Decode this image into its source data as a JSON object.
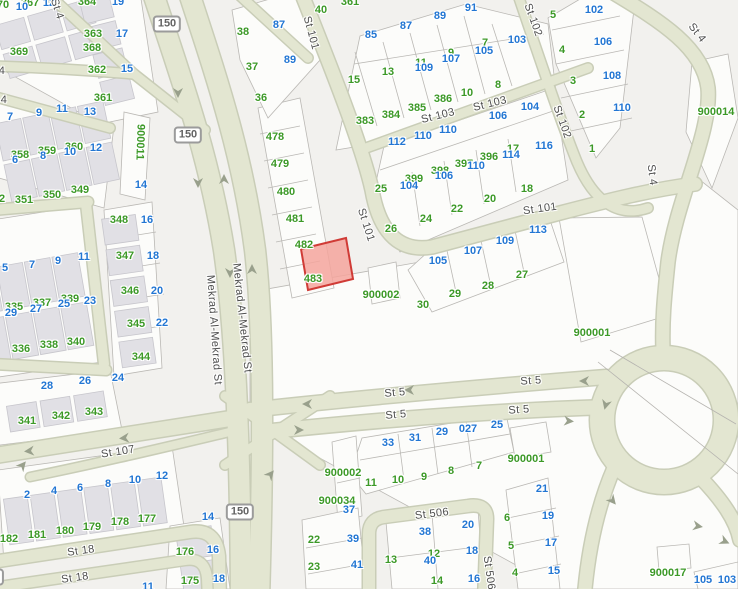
{
  "map": {
    "type": "cadastral-street-map",
    "colors": {
      "g": "#3c9927",
      "b": "#2276d3",
      "road_fill": "#e3e6d1",
      "road_casing": "#c9cdb7",
      "highlight_fill": "#f4a49c",
      "highlight_stroke": "#d03b36"
    },
    "highlighted_parcel": {
      "near_numbers": [
        "482",
        "483"
      ]
    },
    "number_labels": [
      {
        "t": "70",
        "x": 3,
        "y": 5,
        "c": "g"
      },
      {
        "t": "367",
        "x": 30,
        "y": 3,
        "c": "g"
      },
      {
        "t": "364",
        "x": 87,
        "y": 2,
        "c": "g"
      },
      {
        "t": "369",
        "x": 19,
        "y": 52,
        "c": "g"
      },
      {
        "t": "368",
        "x": 92,
        "y": 48,
        "c": "g"
      },
      {
        "t": "363",
        "x": 93,
        "y": 34,
        "c": "g"
      },
      {
        "t": "362",
        "x": 97,
        "y": 70,
        "c": "g"
      },
      {
        "t": "361",
        "x": 103,
        "y": 98,
        "c": "g"
      },
      {
        "t": "361",
        "x": 350,
        "y": 2,
        "c": "g"
      },
      {
        "t": "40",
        "x": 321,
        "y": 10,
        "c": "g"
      },
      {
        "t": "38",
        "x": 243,
        "y": 32,
        "c": "g"
      },
      {
        "t": "37",
        "x": 252,
        "y": 67,
        "c": "g"
      },
      {
        "t": "36",
        "x": 261,
        "y": 98,
        "c": "g"
      },
      {
        "t": "358",
        "x": 20,
        "y": 155,
        "c": "g"
      },
      {
        "t": "359",
        "x": 47,
        "y": 151,
        "c": "g"
      },
      {
        "t": "360",
        "x": 74,
        "y": 147,
        "c": "g"
      },
      {
        "t": "352",
        "x": -4,
        "y": 199,
        "c": "g"
      },
      {
        "t": "351",
        "x": 24,
        "y": 200,
        "c": "g"
      },
      {
        "t": "350",
        "x": 52,
        "y": 195,
        "c": "g"
      },
      {
        "t": "349",
        "x": 80,
        "y": 190,
        "c": "g"
      },
      {
        "t": "348",
        "x": 119,
        "y": 220,
        "c": "g"
      },
      {
        "t": "347",
        "x": 125,
        "y": 256,
        "c": "g"
      },
      {
        "t": "346",
        "x": 130,
        "y": 291,
        "c": "g"
      },
      {
        "t": "345",
        "x": 136,
        "y": 324,
        "c": "g"
      },
      {
        "t": "344",
        "x": 141,
        "y": 357,
        "c": "g"
      },
      {
        "t": "335",
        "x": 14,
        "y": 307,
        "c": "g"
      },
      {
        "t": "337",
        "x": 42,
        "y": 303,
        "c": "g"
      },
      {
        "t": "339",
        "x": 70,
        "y": 299,
        "c": "g"
      },
      {
        "t": "336",
        "x": 21,
        "y": 349,
        "c": "g"
      },
      {
        "t": "338",
        "x": 49,
        "y": 345,
        "c": "g"
      },
      {
        "t": "340",
        "x": 76,
        "y": 342,
        "c": "g"
      },
      {
        "t": "341",
        "x": 27,
        "y": 421,
        "c": "g"
      },
      {
        "t": "342",
        "x": 61,
        "y": 416,
        "c": "g"
      },
      {
        "t": "343",
        "x": 94,
        "y": 412,
        "c": "g"
      },
      {
        "t": "182",
        "x": 9,
        "y": 539,
        "c": "g"
      },
      {
        "t": "181",
        "x": 37,
        "y": 535,
        "c": "g"
      },
      {
        "t": "180",
        "x": 65,
        "y": 531,
        "c": "g"
      },
      {
        "t": "179",
        "x": 92,
        "y": 527,
        "c": "g"
      },
      {
        "t": "178",
        "x": 120,
        "y": 522,
        "c": "g"
      },
      {
        "t": "177",
        "x": 147,
        "y": 519,
        "c": "g"
      },
      {
        "t": "176",
        "x": 185,
        "y": 552,
        "c": "g"
      },
      {
        "t": "175",
        "x": 190,
        "y": 581,
        "c": "g"
      },
      {
        "t": "478",
        "x": 275,
        "y": 137,
        "c": "g"
      },
      {
        "t": "479",
        "x": 280,
        "y": 164,
        "c": "g"
      },
      {
        "t": "480",
        "x": 286,
        "y": 192,
        "c": "g"
      },
      {
        "t": "481",
        "x": 295,
        "y": 219,
        "c": "g"
      },
      {
        "t": "482",
        "x": 304,
        "y": 245,
        "c": "g"
      },
      {
        "t": "483",
        "x": 313,
        "y": 279,
        "c": "g"
      },
      {
        "t": "15",
        "x": 354,
        "y": 80,
        "c": "g"
      },
      {
        "t": "13",
        "x": 388,
        "y": 72,
        "c": "g"
      },
      {
        "t": "11",
        "x": 421,
        "y": 63,
        "c": "g"
      },
      {
        "t": "9",
        "x": 451,
        "y": 53,
        "c": "g"
      },
      {
        "t": "7",
        "x": 485,
        "y": 43,
        "c": "g"
      },
      {
        "t": "10",
        "x": 467,
        "y": 93,
        "c": "g"
      },
      {
        "t": "8",
        "x": 498,
        "y": 85,
        "c": "g"
      },
      {
        "t": "383",
        "x": 365,
        "y": 121,
        "c": "g"
      },
      {
        "t": "384",
        "x": 391,
        "y": 115,
        "c": "g"
      },
      {
        "t": "385",
        "x": 417,
        "y": 108,
        "c": "g"
      },
      {
        "t": "386",
        "x": 443,
        "y": 99,
        "c": "g"
      },
      {
        "t": "399",
        "x": 414,
        "y": 179,
        "c": "g"
      },
      {
        "t": "398",
        "x": 440,
        "y": 171,
        "c": "g"
      },
      {
        "t": "397",
        "x": 464,
        "y": 164,
        "c": "g"
      },
      {
        "t": "396",
        "x": 489,
        "y": 157,
        "c": "g"
      },
      {
        "t": "17",
        "x": 513,
        "y": 149,
        "c": "g"
      },
      {
        "t": "18",
        "x": 527,
        "y": 189,
        "c": "g"
      },
      {
        "t": "25",
        "x": 381,
        "y": 189,
        "c": "g"
      },
      {
        "t": "26",
        "x": 391,
        "y": 229,
        "c": "g"
      },
      {
        "t": "24",
        "x": 426,
        "y": 219,
        "c": "g"
      },
      {
        "t": "22",
        "x": 457,
        "y": 209,
        "c": "g"
      },
      {
        "t": "20",
        "x": 490,
        "y": 199,
        "c": "g"
      },
      {
        "t": "30",
        "x": 423,
        "y": 305,
        "c": "g"
      },
      {
        "t": "29",
        "x": 455,
        "y": 294,
        "c": "g"
      },
      {
        "t": "28",
        "x": 488,
        "y": 286,
        "c": "g"
      },
      {
        "t": "27",
        "x": 522,
        "y": 275,
        "c": "g"
      },
      {
        "t": "5",
        "x": 553,
        "y": 15,
        "c": "g"
      },
      {
        "t": "4",
        "x": 562,
        "y": 50,
        "c": "g"
      },
      {
        "t": "3",
        "x": 573,
        "y": 81,
        "c": "g"
      },
      {
        "t": "2",
        "x": 582,
        "y": 115,
        "c": "g"
      },
      {
        "t": "1",
        "x": 592,
        "y": 149,
        "c": "g"
      },
      {
        "t": "900011",
        "x": 140,
        "y": 142,
        "c": "g",
        "r": 92
      },
      {
        "t": "900014",
        "x": 716,
        "y": 112,
        "c": "g"
      },
      {
        "t": "900001",
        "x": 592,
        "y": 333,
        "c": "g"
      },
      {
        "t": "900002",
        "x": 381,
        "y": 295,
        "c": "g"
      },
      {
        "t": "900002",
        "x": 343,
        "y": 473,
        "c": "g"
      },
      {
        "t": "900034",
        "x": 337,
        "y": 501,
        "c": "g"
      },
      {
        "t": "900001",
        "x": 526,
        "y": 459,
        "c": "g"
      },
      {
        "t": "900017",
        "x": 668,
        "y": 573,
        "c": "g"
      },
      {
        "t": "11",
        "x": 371,
        "y": 483,
        "c": "g"
      },
      {
        "t": "10",
        "x": 398,
        "y": 480,
        "c": "g"
      },
      {
        "t": "9",
        "x": 424,
        "y": 477,
        "c": "g"
      },
      {
        "t": "8",
        "x": 451,
        "y": 471,
        "c": "g"
      },
      {
        "t": "7",
        "x": 479,
        "y": 466,
        "c": "g"
      },
      {
        "t": "22",
        "x": 314,
        "y": 540,
        "c": "g"
      },
      {
        "t": "23",
        "x": 314,
        "y": 567,
        "c": "g"
      },
      {
        "t": "13",
        "x": 391,
        "y": 560,
        "c": "g"
      },
      {
        "t": "12",
        "x": 434,
        "y": 554,
        "c": "g"
      },
      {
        "t": "14",
        "x": 437,
        "y": 581,
        "c": "g"
      },
      {
        "t": "6",
        "x": 507,
        "y": 518,
        "c": "g"
      },
      {
        "t": "5",
        "x": 511,
        "y": 546,
        "c": "g"
      },
      {
        "t": "4",
        "x": 515,
        "y": 573,
        "c": "g"
      },
      {
        "t": "10",
        "x": 22,
        "y": 7,
        "c": "b"
      },
      {
        "t": "12",
        "x": 49,
        "y": 3,
        "c": "b"
      },
      {
        "t": "19",
        "x": 118,
        "y": 2,
        "c": "b"
      },
      {
        "t": "17",
        "x": 122,
        "y": 34,
        "c": "b"
      },
      {
        "t": "15",
        "x": 127,
        "y": 69,
        "c": "b"
      },
      {
        "t": "7",
        "x": 10,
        "y": 117,
        "c": "b"
      },
      {
        "t": "9",
        "x": 39,
        "y": 113,
        "c": "b"
      },
      {
        "t": "11",
        "x": 62,
        "y": 109,
        "c": "b"
      },
      {
        "t": "13",
        "x": 90,
        "y": 112,
        "c": "b"
      },
      {
        "t": "6",
        "x": 15,
        "y": 160,
        "c": "b"
      },
      {
        "t": "8",
        "x": 43,
        "y": 156,
        "c": "b"
      },
      {
        "t": "10",
        "x": 70,
        "y": 152,
        "c": "b"
      },
      {
        "t": "12",
        "x": 96,
        "y": 148,
        "c": "b"
      },
      {
        "t": "14",
        "x": 141,
        "y": 185,
        "c": "b"
      },
      {
        "t": "16",
        "x": 147,
        "y": 220,
        "c": "b"
      },
      {
        "t": "18",
        "x": 153,
        "y": 256,
        "c": "b"
      },
      {
        "t": "20",
        "x": 157,
        "y": 291,
        "c": "b"
      },
      {
        "t": "22",
        "x": 162,
        "y": 323,
        "c": "b"
      },
      {
        "t": "5",
        "x": 5,
        "y": 268,
        "c": "b"
      },
      {
        "t": "7",
        "x": 32,
        "y": 265,
        "c": "b"
      },
      {
        "t": "9",
        "x": 58,
        "y": 261,
        "c": "b"
      },
      {
        "t": "11",
        "x": 84,
        "y": 257,
        "c": "b"
      },
      {
        "t": "29",
        "x": 11,
        "y": 313,
        "c": "b"
      },
      {
        "t": "27",
        "x": 36,
        "y": 309,
        "c": "b"
      },
      {
        "t": "25",
        "x": 64,
        "y": 304,
        "c": "b"
      },
      {
        "t": "23",
        "x": 90,
        "y": 301,
        "c": "b"
      },
      {
        "t": "28",
        "x": 47,
        "y": 386,
        "c": "b"
      },
      {
        "t": "26",
        "x": 85,
        "y": 381,
        "c": "b"
      },
      {
        "t": "24",
        "x": 118,
        "y": 378,
        "c": "b"
      },
      {
        "t": "2",
        "x": 27,
        "y": 495,
        "c": "b"
      },
      {
        "t": "4",
        "x": 54,
        "y": 491,
        "c": "b"
      },
      {
        "t": "6",
        "x": 80,
        "y": 488,
        "c": "b"
      },
      {
        "t": "8",
        "x": 108,
        "y": 484,
        "c": "b"
      },
      {
        "t": "10",
        "x": 135,
        "y": 480,
        "c": "b"
      },
      {
        "t": "12",
        "x": 162,
        "y": 476,
        "c": "b"
      },
      {
        "t": "14",
        "x": 208,
        "y": 517,
        "c": "b"
      },
      {
        "t": "16",
        "x": 213,
        "y": 550,
        "c": "b"
      },
      {
        "t": "18",
        "x": 219,
        "y": 579,
        "c": "b"
      },
      {
        "t": "11",
        "x": 148,
        "y": 587,
        "c": "b"
      },
      {
        "t": "87",
        "x": 279,
        "y": 25,
        "c": "b"
      },
      {
        "t": "89",
        "x": 290,
        "y": 60,
        "c": "b"
      },
      {
        "t": "85",
        "x": 371,
        "y": 35,
        "c": "b"
      },
      {
        "t": "87",
        "x": 406,
        "y": 26,
        "c": "b"
      },
      {
        "t": "89",
        "x": 440,
        "y": 16,
        "c": "b"
      },
      {
        "t": "91",
        "x": 471,
        "y": 8,
        "c": "b"
      },
      {
        "t": "109",
        "x": 424,
        "y": 68,
        "c": "b"
      },
      {
        "t": "107",
        "x": 451,
        "y": 59,
        "c": "b"
      },
      {
        "t": "105",
        "x": 484,
        "y": 51,
        "c": "b"
      },
      {
        "t": "103",
        "x": 517,
        "y": 40,
        "c": "b"
      },
      {
        "t": "112",
        "x": 397,
        "y": 142,
        "c": "b"
      },
      {
        "t": "110",
        "x": 423,
        "y": 136,
        "c": "b"
      },
      {
        "t": "110",
        "x": 448,
        "y": 130,
        "c": "b"
      },
      {
        "t": "110",
        "x": 476,
        "y": 166,
        "c": "b"
      },
      {
        "t": "106",
        "x": 444,
        "y": 176,
        "c": "b"
      },
      {
        "t": "104",
        "x": 409,
        "y": 186,
        "c": "b"
      },
      {
        "t": "114",
        "x": 511,
        "y": 155,
        "c": "b"
      },
      {
        "t": "116",
        "x": 544,
        "y": 146,
        "c": "b"
      },
      {
        "t": "106",
        "x": 498,
        "y": 116,
        "c": "b"
      },
      {
        "t": "104",
        "x": 530,
        "y": 107,
        "c": "b"
      },
      {
        "t": "102",
        "x": 594,
        "y": 10,
        "c": "b"
      },
      {
        "t": "106",
        "x": 603,
        "y": 42,
        "c": "b"
      },
      {
        "t": "108",
        "x": 612,
        "y": 76,
        "c": "b"
      },
      {
        "t": "110",
        "x": 622,
        "y": 108,
        "c": "b"
      },
      {
        "t": "105",
        "x": 438,
        "y": 261,
        "c": "b"
      },
      {
        "t": "107",
        "x": 473,
        "y": 251,
        "c": "b"
      },
      {
        "t": "109",
        "x": 505,
        "y": 241,
        "c": "b"
      },
      {
        "t": "113",
        "x": 538,
        "y": 230,
        "c": "b"
      },
      {
        "t": "33",
        "x": 388,
        "y": 443,
        "c": "b"
      },
      {
        "t": "31",
        "x": 415,
        "y": 438,
        "c": "b"
      },
      {
        "t": "29",
        "x": 442,
        "y": 432,
        "c": "b"
      },
      {
        "t": "027",
        "x": 468,
        "y": 429,
        "c": "b"
      },
      {
        "t": "25",
        "x": 497,
        "y": 425,
        "c": "b"
      },
      {
        "t": "37",
        "x": 349,
        "y": 510,
        "c": "b"
      },
      {
        "t": "39",
        "x": 353,
        "y": 539,
        "c": "b"
      },
      {
        "t": "41",
        "x": 357,
        "y": 565,
        "c": "b"
      },
      {
        "t": "38",
        "x": 425,
        "y": 532,
        "c": "b"
      },
      {
        "t": "20",
        "x": 468,
        "y": 525,
        "c": "b"
      },
      {
        "t": "40",
        "x": 430,
        "y": 561,
        "c": "b"
      },
      {
        "t": "18",
        "x": 472,
        "y": 551,
        "c": "b"
      },
      {
        "t": "16",
        "x": 474,
        "y": 579,
        "c": "b"
      },
      {
        "t": "21",
        "x": 542,
        "y": 489,
        "c": "b"
      },
      {
        "t": "19",
        "x": 548,
        "y": 516,
        "c": "b"
      },
      {
        "t": "17",
        "x": 551,
        "y": 543,
        "c": "b"
      },
      {
        "t": "15",
        "x": 554,
        "y": 571,
        "c": "b"
      },
      {
        "t": "105",
        "x": 703,
        "y": 580,
        "c": "b"
      },
      {
        "t": "103",
        "x": 727,
        "y": 580,
        "c": "b"
      }
    ],
    "street_labels": [
      {
        "t": "St 4",
        "x": 57,
        "y": 9,
        "r": 72
      },
      {
        "t": "4",
        "x": 2,
        "y": 71,
        "r": 0
      },
      {
        "t": "4",
        "x": 4,
        "y": 100,
        "r": 0
      },
      {
        "t": "St 101",
        "x": 311,
        "y": 33,
        "r": 75
      },
      {
        "t": "St 101",
        "x": 366,
        "y": 225,
        "r": 72
      },
      {
        "t": "St 101",
        "x": 540,
        "y": 209,
        "r": -8
      },
      {
        "t": "St 103",
        "x": 438,
        "y": 116,
        "r": -14
      },
      {
        "t": "St 103",
        "x": 490,
        "y": 104,
        "r": -14
      },
      {
        "t": "St 102",
        "x": 533,
        "y": 20,
        "r": 70
      },
      {
        "t": "St 102",
        "x": 562,
        "y": 122,
        "r": 70
      },
      {
        "t": "St 4",
        "x": 697,
        "y": 33,
        "r": 52
      },
      {
        "t": "St 4",
        "x": 652,
        "y": 175,
        "r": 83
      },
      {
        "t": "Mekrad Al-Mekrad St",
        "x": 214,
        "y": 330,
        "r": 86
      },
      {
        "t": "Mekrad Al-Mekrad St",
        "x": 242,
        "y": 318,
        "r": 84
      },
      {
        "t": "St 107",
        "x": 118,
        "y": 452,
        "r": -9
      },
      {
        "t": "St 5",
        "x": 395,
        "y": 393,
        "r": -5
      },
      {
        "t": "St 5",
        "x": 531,
        "y": 381,
        "r": -4
      },
      {
        "t": "St 5",
        "x": 396,
        "y": 415,
        "r": -5
      },
      {
        "t": "St 5",
        "x": 519,
        "y": 410,
        "r": -4
      },
      {
        "t": "St 18",
        "x": 81,
        "y": 551,
        "r": -8
      },
      {
        "t": "St 18",
        "x": 75,
        "y": 578,
        "r": -8
      },
      {
        "t": "St 506",
        "x": 432,
        "y": 514,
        "r": -7
      },
      {
        "t": "St 506",
        "x": 489,
        "y": 573,
        "r": 82
      }
    ],
    "route_shields": [
      {
        "t": "150",
        "x": 167,
        "y": 24
      },
      {
        "t": "150",
        "x": 188,
        "y": 135
      },
      {
        "t": "150",
        "x": 240,
        "y": 512
      },
      {
        "t": "3",
        "x": -4,
        "y": 577
      }
    ]
  }
}
